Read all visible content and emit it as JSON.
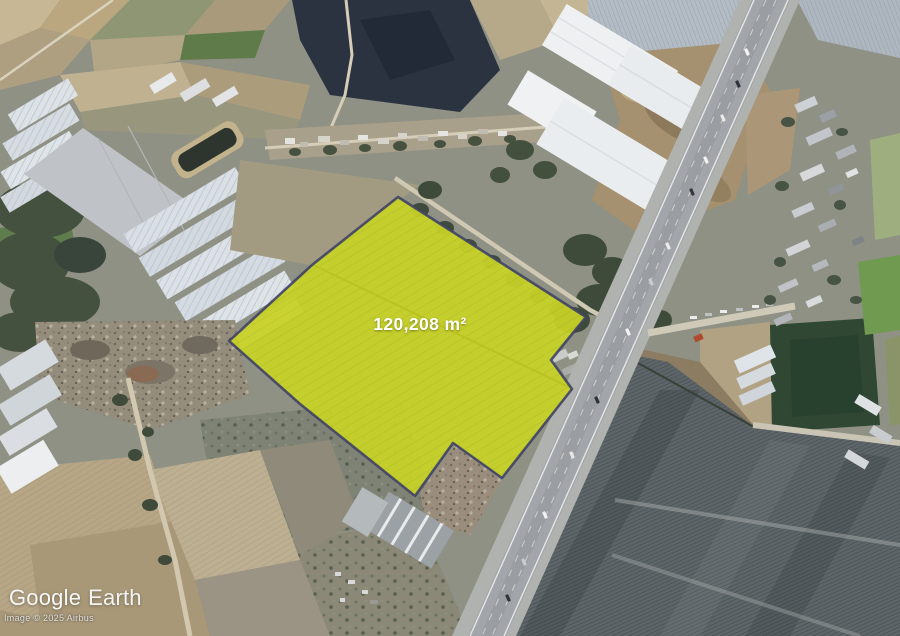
{
  "parcel": {
    "area_label": "120,208 m²",
    "fill_color": "#c8d126",
    "border_color": "#3f4266"
  },
  "branding": {
    "google": "Google",
    "earth": "Earth"
  },
  "attribution": {
    "text": "Image © 2025 Airbus"
  }
}
